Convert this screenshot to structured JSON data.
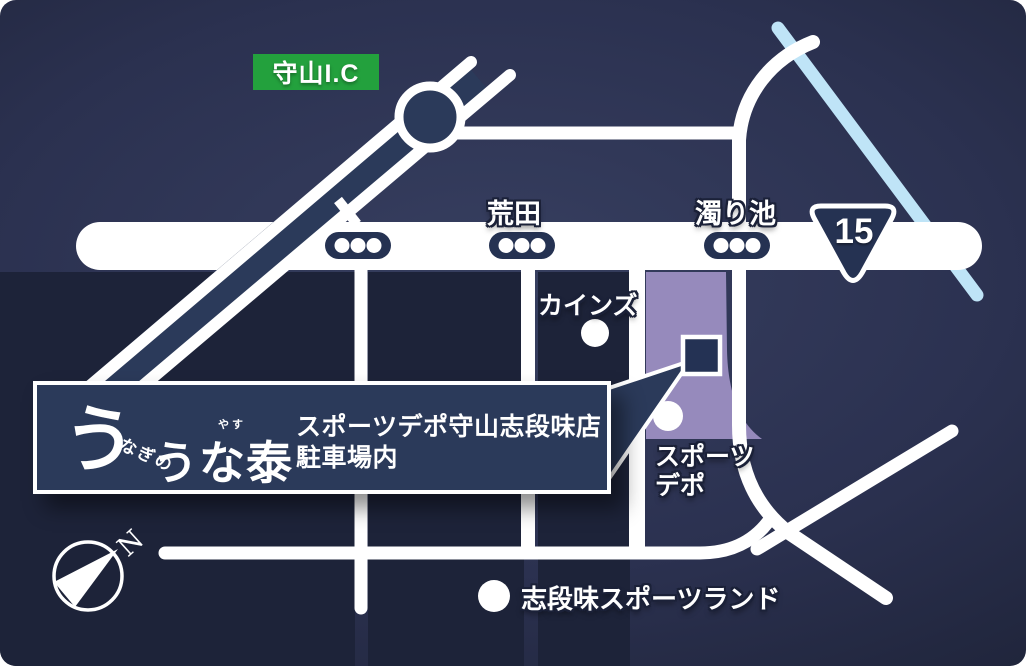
{
  "map": {
    "ic_badge": {
      "label": "守山I.C"
    },
    "route_badge": {
      "number": "15"
    },
    "signals": {
      "arata": "荒田",
      "nigoriike": "濁り池"
    },
    "landmarks": {
      "cainz": "カインズ",
      "sports_depo_line1": "スポーツ",
      "sports_depo_line2": "デポ",
      "shidami_sportsland": "志段味スポーツランド"
    },
    "info_box": {
      "logo_big_u": "う",
      "logo_nagino": "なぎの",
      "logo_name": "うな泰",
      "logo_furigana": "やす",
      "line1": "スポーツデポ守山志段味店",
      "line2": "駐車場内"
    },
    "compass": {
      "north_label": "N"
    },
    "colors": {
      "background_navy": "#2b3150",
      "block_navy": "#1d2339",
      "road_white": "#ffffff",
      "highlight_purple": "#968abc",
      "panel_navy": "#2b3a5a",
      "signal_navy": "#253252",
      "green_badge": "#23a13d",
      "water_blue": "#bfe4f7"
    }
  }
}
